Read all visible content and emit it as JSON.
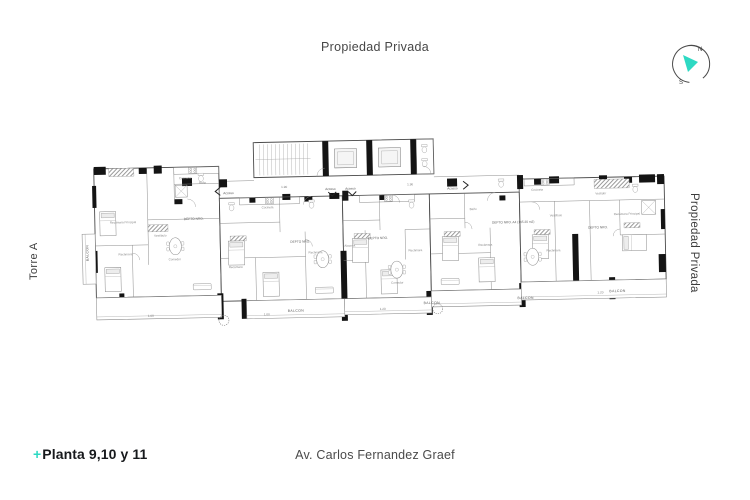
{
  "page": {
    "top_label": "Propiedad Privada",
    "left_label": "Torre A",
    "right_label": "Propiedad Privada",
    "title_plus": "+",
    "title": "Planta 9,10 y 11",
    "street": "Av. Carlos Fernandez Graef",
    "colors": {
      "accent": "#2ed9c3",
      "ink": "#17191c",
      "label": "#474747"
    }
  },
  "compass": {
    "n": "N",
    "s": "S"
  },
  "plan": {
    "acceso": [
      "Acceso",
      "Acceso",
      "Acceso",
      "Acceso"
    ],
    "balcon": [
      "BALCON",
      "BALCON",
      "BALCON",
      "BALCON",
      "BALCON"
    ],
    "depto": [
      "DEPTO NRO.",
      "DEPTO NRO.",
      "DEPTO NRO.",
      "DEPTO NRO. A4 (145.20 m2)",
      "DEPTO NRO."
    ],
    "dims": [
      "1.90",
      "1.90",
      "1.00",
      "1.00",
      "1.20",
      "1.20"
    ],
    "rooms": [
      "Recámara",
      "Recámara",
      "Recámara",
      "Recámara",
      "Recámara",
      "Recámara",
      "Recámara Principal",
      "Recámara Principal",
      "Comedor",
      "Comedor",
      "Cocineta",
      "Cocineta",
      "Cocineta",
      "Vestíbulo",
      "Vestíbulo",
      "Vestidor",
      "Baño",
      "Baño",
      "Alacena"
    ]
  }
}
